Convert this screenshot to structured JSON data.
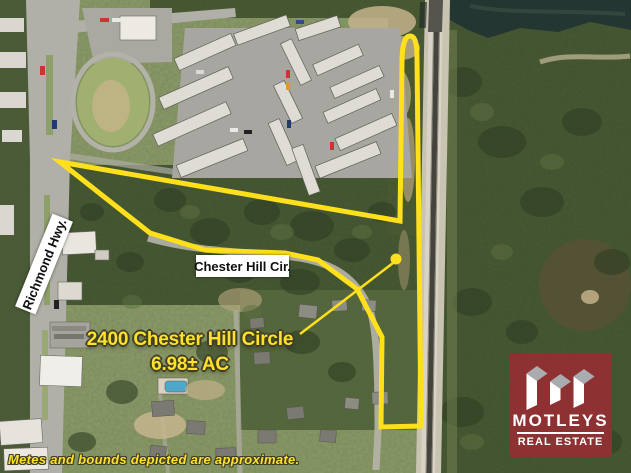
{
  "property": {
    "title": "2400 Chester Hill Circle",
    "acreage": "6.98± AC"
  },
  "roads": {
    "richmond_hwy": "Richmond Hwy.",
    "chester_hill_cir": "Chester Hill Cir."
  },
  "disclaimer": {
    "text": "Metes and bounds depicted are approximate."
  },
  "logo": {
    "name": "MOTLEYS",
    "subtitle": "REAL ESTATE"
  },
  "colors": {
    "boundary": "#FFE01A",
    "annotation": "#FFE02E",
    "annotation_outline": "#3F3F24",
    "label_bg": "#FFFFFF",
    "label_text": "#101010",
    "logo_bg": "#8E3132",
    "logo_mark_top": "#A9ABAE",
    "logo_text": "#FFFFFF"
  }
}
